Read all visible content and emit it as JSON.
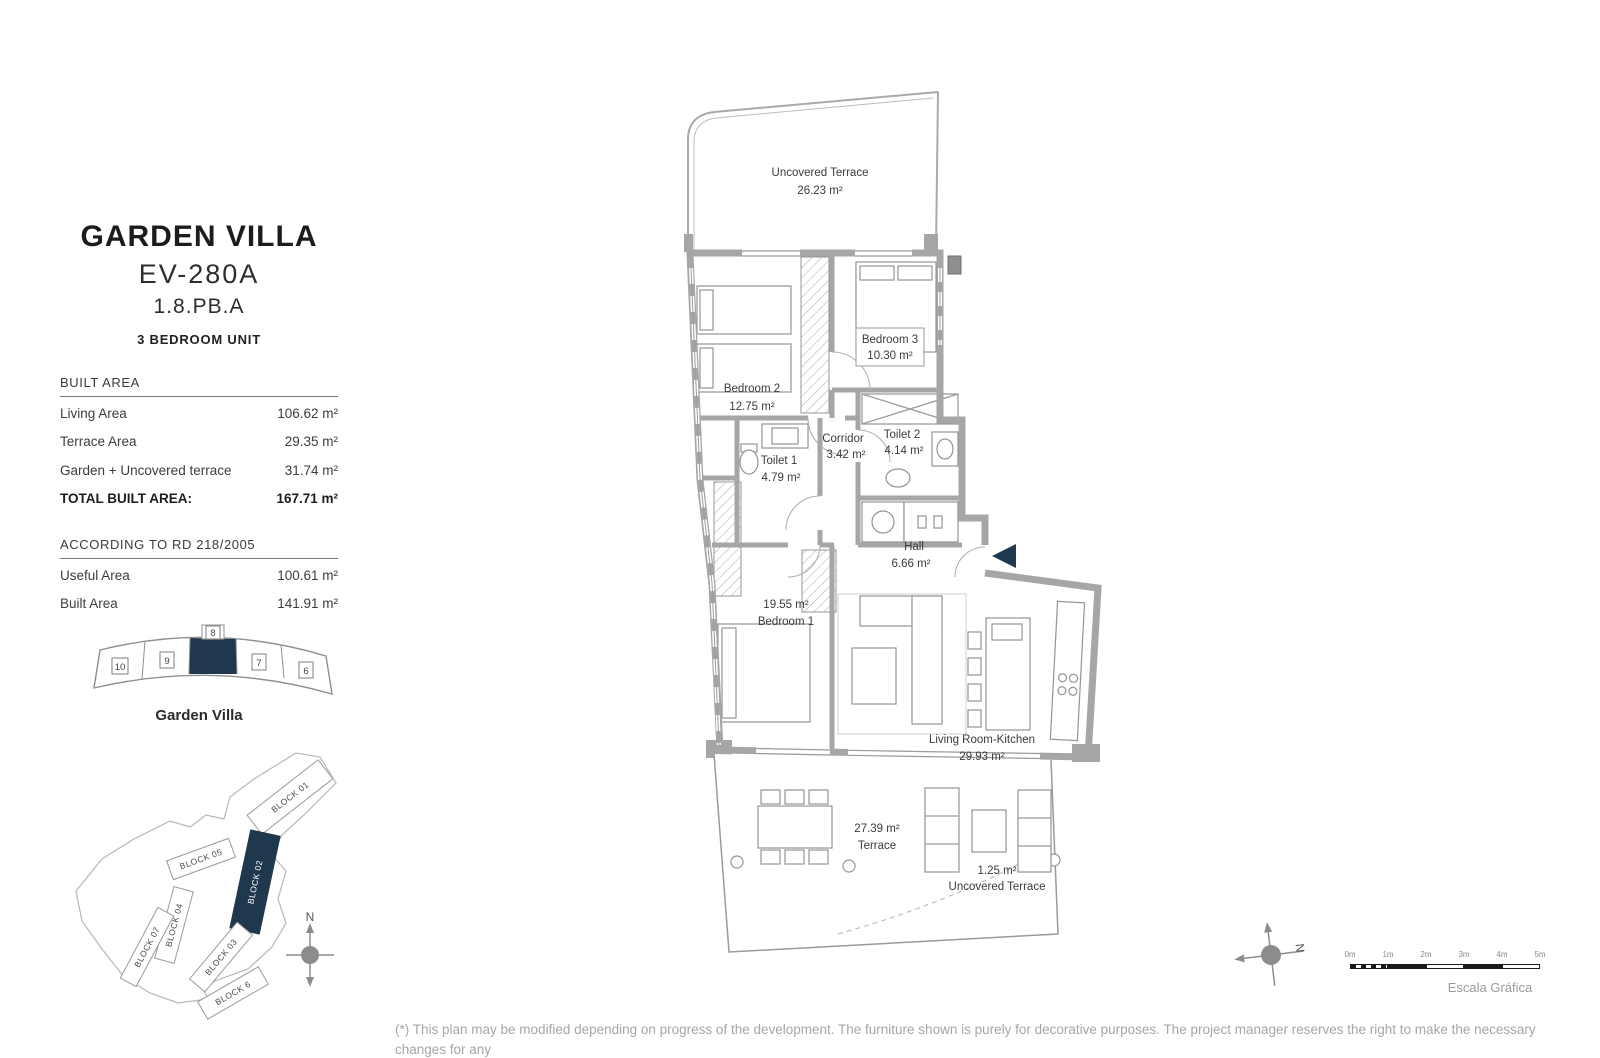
{
  "colors": {
    "accent_navy": "#20384e",
    "wall_gray": "#a6a6a6",
    "text_dark": "#3c3c3c",
    "muted_gray": "#a6a6a6"
  },
  "header": {
    "title": "GARDEN VILLA",
    "model": "EV-280A",
    "unit_ref": "1.8.PB.A",
    "unit_type": "3 BEDROOM UNIT"
  },
  "built_area": {
    "heading": "BUILT AREA",
    "rows": [
      {
        "label": "Living Area",
        "value": "106.62 m²"
      },
      {
        "label": "Terrace Area",
        "value": "29.35 m²"
      },
      {
        "label": "Garden + Uncovered terrace",
        "value": "31.74 m²"
      }
    ],
    "total": {
      "label": "TOTAL BUILT AREA:",
      "value": "167.71 m²"
    }
  },
  "rd218": {
    "heading": "ACCORDING TO RD 218/2005",
    "rows": [
      {
        "label": "Useful Area",
        "value": "100.61 m²"
      },
      {
        "label": "Built Area",
        "value": "141.91 m²"
      }
    ]
  },
  "unit_strip": {
    "units": [
      "10",
      "9",
      "8",
      "7",
      "6"
    ],
    "highlighted_unit": "8",
    "caption": "Garden Villa"
  },
  "site_plan": {
    "blocks": [
      "BLOCK 01",
      "BLOCK 02",
      "BLOCK 05",
      "BLOCK 04",
      "BLOCK 07",
      "BLOCK 03",
      "BLOCK 6"
    ],
    "highlighted_block": "BLOCK 02",
    "north_label": "N"
  },
  "floor_plan": {
    "north_label": "N",
    "rooms": [
      {
        "name": "Uncovered Terrace",
        "area": "26.23 m²"
      },
      {
        "name": "Bedroom 2",
        "area": "12.75 m²"
      },
      {
        "name": "Bedroom 3",
        "area": "10.30 m²"
      },
      {
        "name": "Toilet 1",
        "area": "4.79 m²"
      },
      {
        "name": "Toilet 2",
        "area": "4.14 m²"
      },
      {
        "name": "Corridor",
        "area": "3.42 m²"
      },
      {
        "name": "Hall",
        "area": "6.66 m²"
      },
      {
        "name": "Bedroom 1",
        "area": "19.55 m²"
      },
      {
        "name": "Living Room-Kitchen",
        "area": "29.93 m²"
      },
      {
        "name": "Terrace",
        "area": "27.39 m²"
      },
      {
        "name": "Uncovered Terrace",
        "area": "1.25 m²"
      }
    ]
  },
  "scale_bar": {
    "tick_labels": [
      "0m",
      "1m",
      "2m",
      "3m",
      "4m",
      "5m"
    ],
    "caption": "Escala Gráfica"
  },
  "footer": {
    "lines": [
      "(*) This plan may be modified depending on progress of the development. The furniture shown is purely for decorative purposes. The project manager reserves the right to make the necessary changes for any",
      "possible functional, aesthetic and legal reasons, without this negatively affecting the quality of the construction. Illustrative dimensions."
    ]
  }
}
